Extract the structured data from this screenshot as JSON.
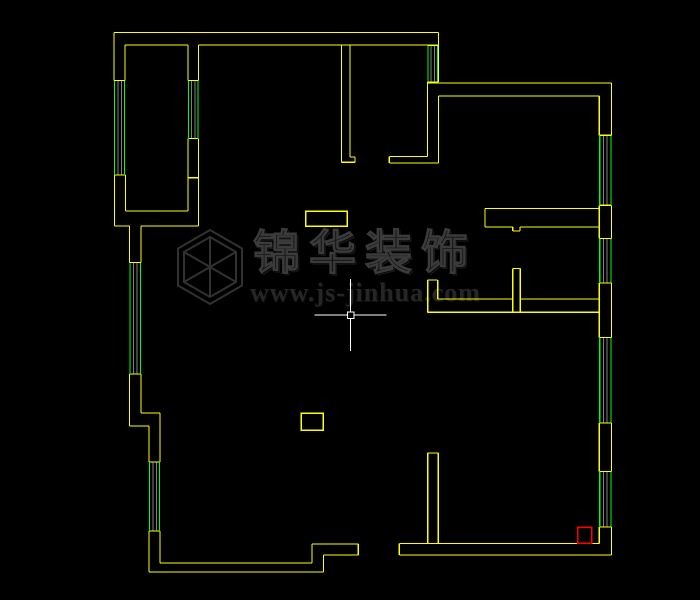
{
  "canvas": {
    "width": 700,
    "height": 600,
    "background": "#000000"
  },
  "colors": {
    "wall": "#ffff00",
    "window": "#00ff00",
    "mullion": "#7f7f7f",
    "crosshair": "#ffffff",
    "highlight": "#ff0000",
    "logo_stroke": "#313131"
  },
  "floor_plan": {
    "wall_segments": [
      [
        114,
        32.5,
        438.5,
        32.5
      ],
      [
        114,
        32.5,
        114,
        80.5
      ],
      [
        125,
        45,
        188,
        45
      ],
      [
        198.5,
        45,
        427.5,
        45
      ],
      [
        125,
        45,
        125,
        80.5
      ],
      [
        114,
        80.5,
        125,
        80.5
      ],
      [
        114.5,
        175,
        125.5,
        175
      ],
      [
        114.5,
        175,
        114.5,
        226
      ],
      [
        125.5,
        175,
        125.5,
        211
      ],
      [
        125.5,
        211,
        188,
        211
      ],
      [
        188,
        138.5,
        188,
        211
      ],
      [
        188,
        177.7,
        198.5,
        177.7
      ],
      [
        198.5,
        138.5,
        198.5,
        226
      ],
      [
        114.5,
        226,
        129.5,
        226
      ],
      [
        141,
        226,
        198.5,
        226
      ],
      [
        129.5,
        226,
        129.5,
        262.5
      ],
      [
        141,
        226,
        141,
        262.5
      ],
      [
        188,
        45,
        188,
        80.5
      ],
      [
        198.5,
        45,
        198.5,
        80.5
      ],
      [
        188,
        80.5,
        198.5,
        80.5
      ],
      [
        188,
        138.5,
        198.5,
        138.5
      ],
      [
        129.5,
        262.5,
        141,
        262.5
      ],
      [
        129.5,
        374,
        141,
        374
      ],
      [
        129.5,
        374,
        129.5,
        426
      ],
      [
        141,
        374,
        141,
        413
      ],
      [
        141,
        413,
        160,
        413
      ],
      [
        129.5,
        426,
        149,
        426
      ],
      [
        149,
        426,
        149,
        462
      ],
      [
        160,
        413,
        160,
        462
      ],
      [
        149,
        462,
        160,
        462
      ],
      [
        149,
        531,
        160,
        531
      ],
      [
        149,
        531,
        149,
        572
      ],
      [
        160,
        531,
        160,
        563
      ],
      [
        160,
        563,
        312,
        563
      ],
      [
        149,
        572,
        323.5,
        572
      ],
      [
        312,
        544,
        312,
        563
      ],
      [
        323.5,
        555,
        323.5,
        572
      ],
      [
        312,
        544,
        358.3,
        544
      ],
      [
        323.5,
        555,
        358.3,
        555
      ],
      [
        358.3,
        544,
        358.3,
        555
      ],
      [
        399.3,
        543.5,
        399.3,
        555
      ],
      [
        399.3,
        543.5,
        599.3,
        543.5
      ],
      [
        399.3,
        555,
        611.5,
        555
      ],
      [
        438.5,
        32.5,
        438.5,
        82
      ],
      [
        427.5,
        45.3,
        438.5,
        45.3
      ],
      [
        427.5,
        82,
        438.5,
        82
      ],
      [
        427.5,
        83,
        611.5,
        83
      ],
      [
        438.5,
        96,
        599.3,
        96
      ],
      [
        611.5,
        83,
        611.5,
        135.3
      ],
      [
        599.3,
        96,
        599.3,
        135.3
      ],
      [
        599.3,
        135.3,
        611.5,
        135.3
      ],
      [
        599.3,
        205.3,
        611.5,
        205.3
      ],
      [
        599.3,
        205.3,
        599.3,
        238.5
      ],
      [
        611.5,
        205.3,
        611.5,
        238.5
      ],
      [
        599.3,
        238.5,
        611.5,
        238.5
      ],
      [
        599.3,
        283,
        611.5,
        283
      ],
      [
        599.3,
        283,
        599.3,
        337.5
      ],
      [
        611.5,
        283,
        611.5,
        337.5
      ],
      [
        599.3,
        337.5,
        611.5,
        337.5
      ],
      [
        599.3,
        423,
        611.5,
        423
      ],
      [
        599.3,
        423,
        599.3,
        471.5
      ],
      [
        611.5,
        423,
        611.5,
        471.5
      ],
      [
        599.3,
        471.5,
        611.5,
        471.5
      ],
      [
        599.3,
        527,
        611.5,
        527
      ],
      [
        599.3,
        527,
        599.3,
        543.5
      ],
      [
        611.5,
        527,
        611.5,
        555
      ],
      [
        427.5,
        82,
        427.5,
        156.5
      ],
      [
        438.5,
        96,
        438.5,
        163
      ],
      [
        389.3,
        156.5,
        427.5,
        156.5
      ],
      [
        389.3,
        163,
        438.5,
        163
      ],
      [
        389.3,
        156.5,
        389.3,
        163
      ],
      [
        341.5,
        45,
        341.5,
        162.3
      ],
      [
        350,
        45,
        350,
        157
      ],
      [
        350,
        157,
        355,
        157
      ],
      [
        341.5,
        162.3,
        355,
        162.3
      ],
      [
        355,
        157,
        355,
        162.3
      ],
      [
        485,
        208.5,
        599.3,
        208.5
      ],
      [
        485,
        227,
        512.8,
        227
      ],
      [
        520,
        227,
        599.3,
        227
      ],
      [
        485,
        208.5,
        485,
        227
      ],
      [
        512.8,
        227,
        512.8,
        231
      ],
      [
        520,
        227,
        520,
        231
      ],
      [
        512.8,
        231,
        520,
        231
      ],
      [
        512.8,
        268.5,
        520.3,
        268.5
      ],
      [
        512.8,
        268.5,
        512.8,
        312.3
      ],
      [
        520.3,
        268.5,
        520.3,
        312.3
      ],
      [
        437.7,
        299,
        512.8,
        299
      ],
      [
        520.3,
        299,
        599.3,
        299
      ],
      [
        427.7,
        312.3,
        599.3,
        312.3
      ],
      [
        427.7,
        280,
        427.7,
        312.3
      ],
      [
        437.7,
        280,
        437.7,
        299
      ],
      [
        427.7,
        280,
        437.7,
        280
      ],
      [
        427.7,
        453,
        438.3,
        453
      ],
      [
        427.7,
        453,
        427.7,
        543.5
      ],
      [
        438.3,
        453,
        438.3,
        543.5
      ]
    ],
    "window_segments": [
      [
        114.5,
        81,
        114.5,
        175
      ],
      [
        124.5,
        81,
        124.5,
        175
      ],
      [
        130,
        263,
        130,
        374
      ],
      [
        140.5,
        263,
        140.5,
        374
      ],
      [
        149.5,
        462,
        149.5,
        531
      ],
      [
        159.5,
        462,
        159.5,
        531
      ],
      [
        188.5,
        81,
        188.5,
        139
      ],
      [
        198,
        81,
        198,
        139
      ],
      [
        428,
        46,
        428,
        81.5
      ],
      [
        437.5,
        46,
        437.5,
        81.5
      ],
      [
        599.8,
        136,
        599.8,
        205
      ],
      [
        611,
        136,
        611,
        205
      ],
      [
        599.8,
        239,
        599.8,
        282.5
      ],
      [
        611,
        239,
        611,
        282.5
      ],
      [
        599.8,
        338,
        599.8,
        422.5
      ],
      [
        611,
        338,
        611,
        422.5
      ],
      [
        599.8,
        472,
        599.8,
        526.5
      ],
      [
        611,
        472,
        611,
        526.5
      ]
    ],
    "mullion_segments": [
      [
        118,
        81,
        118,
        175
      ],
      [
        121.3,
        81,
        121.3,
        175
      ],
      [
        133.5,
        263,
        133.5,
        374
      ],
      [
        137,
        263,
        137,
        374
      ],
      [
        153,
        462,
        153,
        531
      ],
      [
        156.3,
        462,
        156.3,
        531
      ],
      [
        191.5,
        81,
        191.5,
        139
      ],
      [
        194.8,
        81,
        194.8,
        139
      ],
      [
        431,
        46,
        431,
        81.5
      ],
      [
        434.3,
        46,
        434.3,
        81.5
      ],
      [
        603.5,
        136,
        603.5,
        205
      ],
      [
        607.2,
        136,
        607.2,
        205
      ],
      [
        603.5,
        239,
        603.5,
        282.5
      ],
      [
        607.2,
        239,
        607.2,
        282.5
      ],
      [
        603.5,
        338,
        603.5,
        422.5
      ],
      [
        607.2,
        338,
        607.2,
        422.5
      ],
      [
        603.5,
        472,
        603.5,
        526.5
      ],
      [
        607.2,
        472,
        607.2,
        526.5
      ]
    ],
    "rectangles": [
      {
        "x": 305.7,
        "y": 211,
        "w": 41.6,
        "h": 15,
        "color": "wall"
      },
      {
        "x": 301,
        "y": 413.3,
        "w": 22.3,
        "h": 16.7,
        "color": "wall"
      },
      {
        "x": 577.7,
        "y": 527.3,
        "w": 14,
        "h": 16,
        "color": "highlight"
      }
    ]
  },
  "crosshair": {
    "x": 350.7,
    "y": 315,
    "arm": 36,
    "pickbox": 6.5
  },
  "watermark": {
    "title": "锦华装饰",
    "url": "www.js-jinhua.com",
    "logo": {
      "cx": 38,
      "cy": 38,
      "outer_r": 37,
      "inner_r": 30
    }
  }
}
